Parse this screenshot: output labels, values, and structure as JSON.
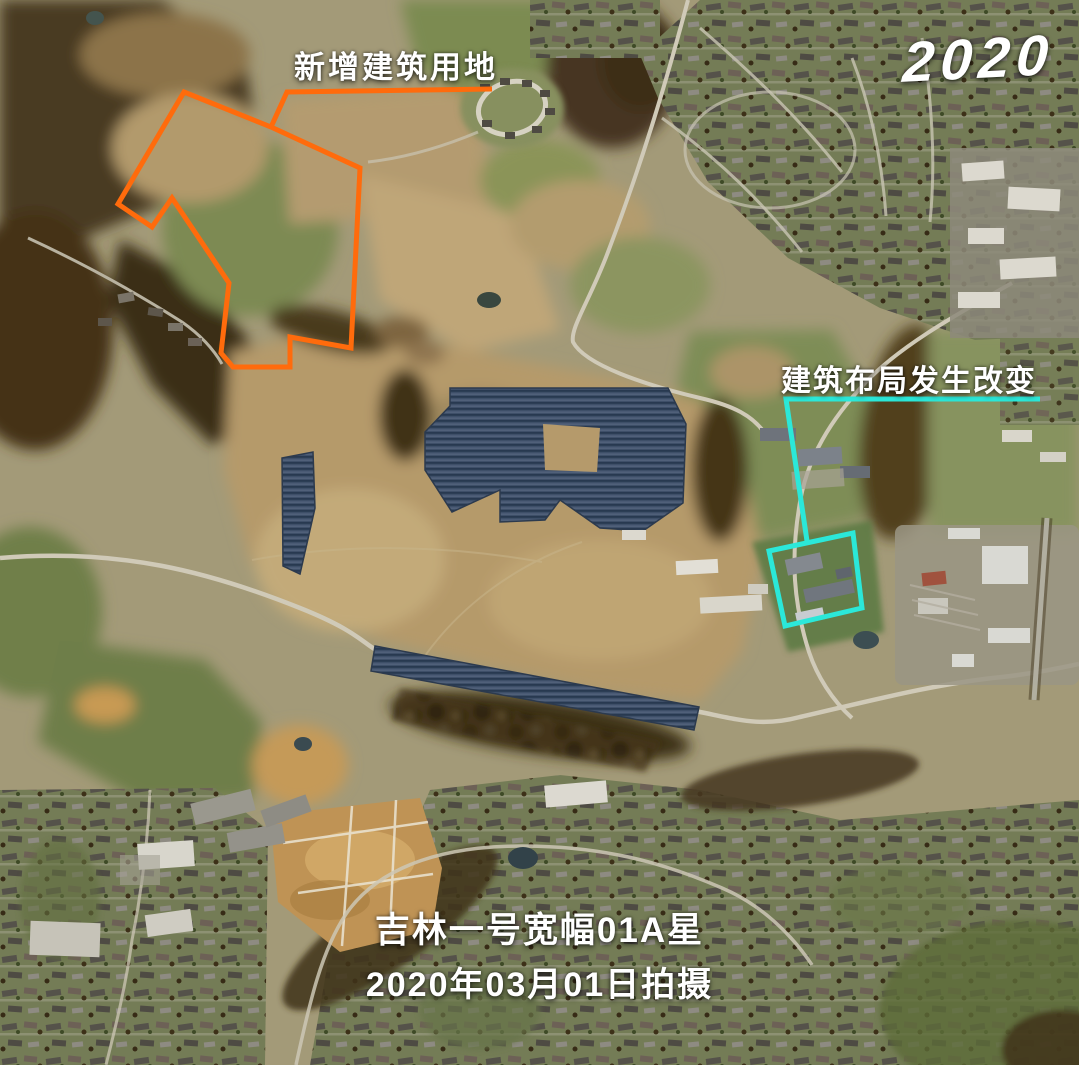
{
  "year_badge": {
    "text": "2020"
  },
  "annotations": {
    "new_construction": {
      "label": "新增建筑用地",
      "color": "#FF6B0C",
      "polygon_points": "184,92 271,127 360,168 351,348 290,337 290,367 233,367 221,353 229,283 172,198 152,227 118,204",
      "leader_points": "492,89 287,92 271,127"
    },
    "layout_change": {
      "label": "建筑布局发生改变",
      "color": "#2BE8D9",
      "box_points": "769,551 853,533 862,608 785,626",
      "leader_points": "1040,399 786,399 807,541"
    }
  },
  "caption": {
    "line1": "吉林一号宽幅01A星",
    "line2": "2020年03月01日拍摄"
  }
}
